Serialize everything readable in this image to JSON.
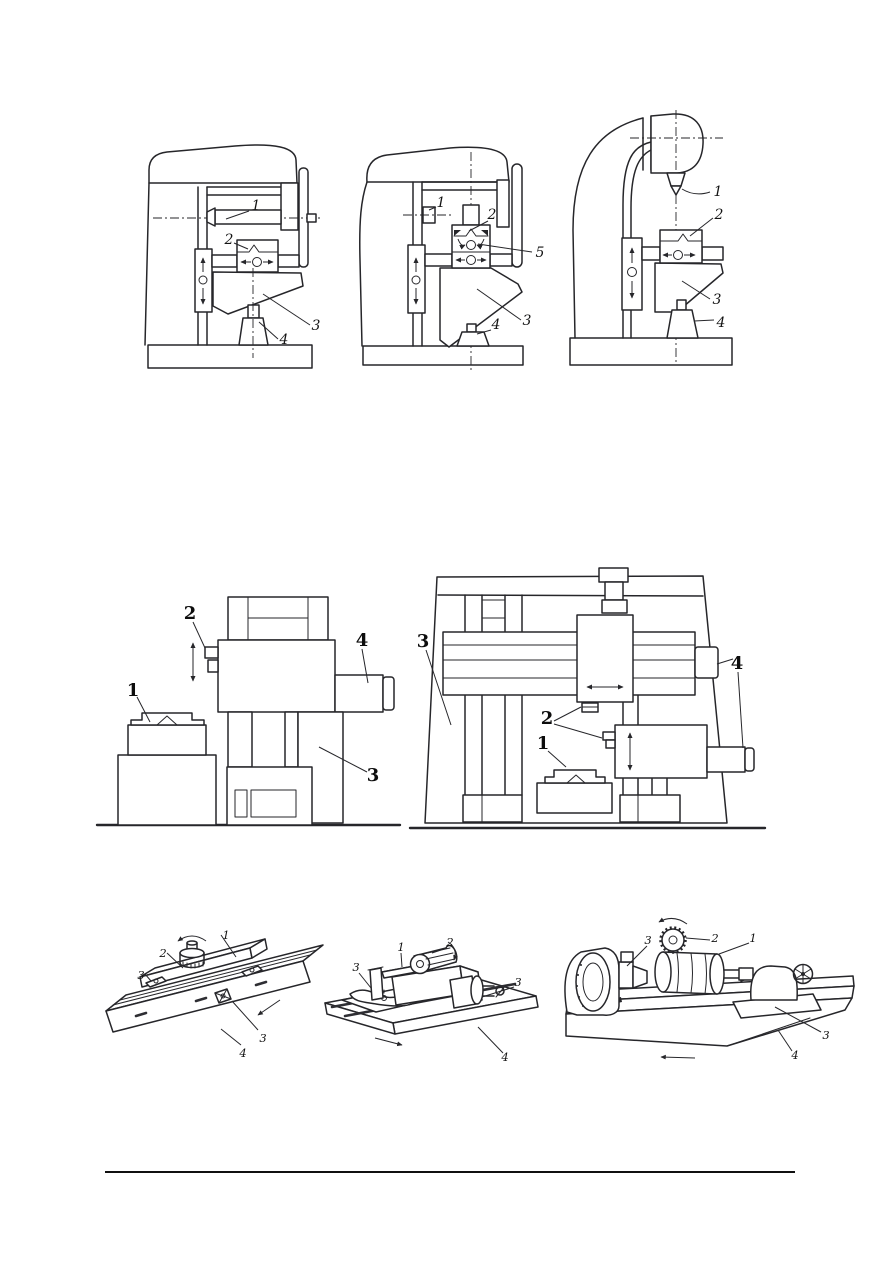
{
  "colors": {
    "background": "#ffffff",
    "ink": "#26262a",
    "label": "#141414"
  },
  "figures": {
    "top_left": {
      "labels": {
        "arbor": "1",
        "workpiece": "2",
        "knee": "3",
        "support": "4"
      }
    },
    "top_middle": {
      "labels": {
        "gearbox": "1",
        "workpiece": "2",
        "swivel_table": "5",
        "knee": "3",
        "support": "4"
      }
    },
    "top_right": {
      "labels": {
        "spindle": "1",
        "workpiece": "2",
        "knee": "3",
        "support": "4"
      }
    },
    "middle_left": {
      "labels": {
        "workpiece": "1",
        "cutter": "2",
        "column": "3",
        "ram": "4"
      }
    },
    "middle_right": {
      "labels": {
        "frame": "3",
        "ram": "4",
        "cutters": "2",
        "workpiece": "1"
      }
    },
    "bottom_left": {
      "labels": {
        "workpiece": "1",
        "cutter": "2",
        "clamp_left": "3",
        "clamp_right": "3",
        "table": "4"
      }
    },
    "bottom_middle": {
      "labels": {
        "workpiece": "1",
        "cutter": "2",
        "clamp_left": "3",
        "vise_jaw": "3",
        "table": "4"
      }
    },
    "bottom_right": {
      "labels": {
        "dividing_head": "3",
        "cutter": "2",
        "workpiece": "1",
        "tailstock": "3",
        "table": "4"
      }
    }
  }
}
